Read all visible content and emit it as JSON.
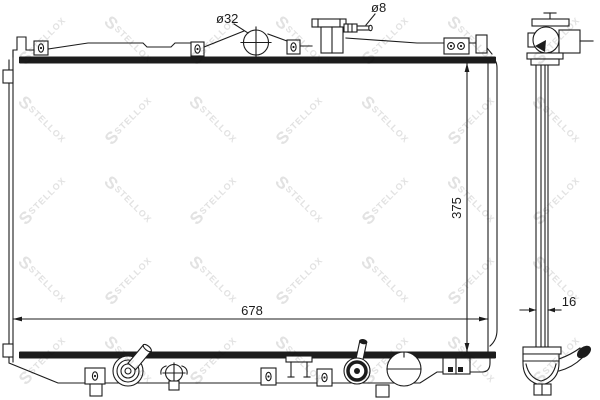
{
  "watermark": {
    "logo_letter": "S",
    "text": "STELLOX",
    "color": "#e2e2e2"
  },
  "annotations": {
    "overall_width": "678",
    "core_height": "375",
    "core_depth": "16",
    "filler_neck_diameter": "ø32",
    "overflow_tube_diameter": "ø8"
  },
  "colors": {
    "line": "#1c1c1c",
    "background": "#ffffff"
  }
}
